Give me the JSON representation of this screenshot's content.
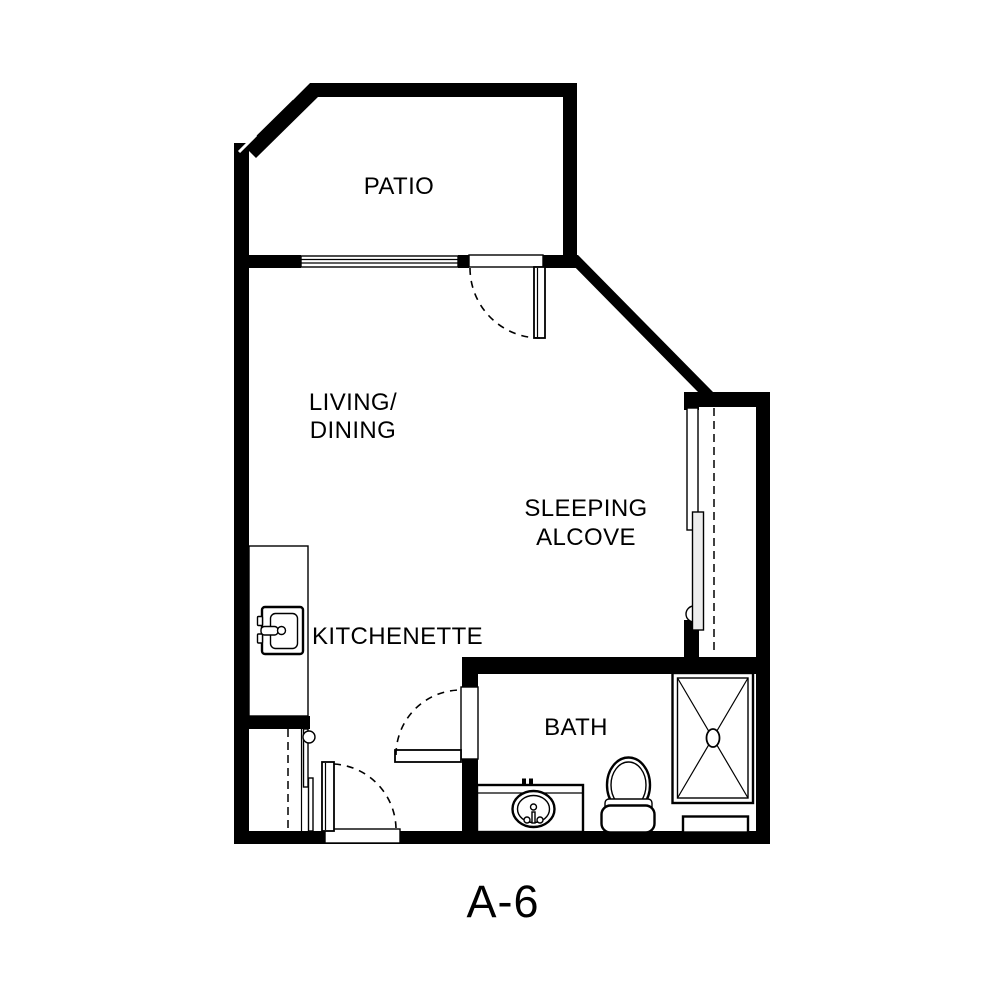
{
  "plan": {
    "title": "A-6",
    "type": "apartment-floor-plan",
    "colors": {
      "background": "#ffffff",
      "wall": "#000000",
      "line": "#000000"
    }
  },
  "rooms": {
    "patio": {
      "label": "PATIO"
    },
    "living_dining": {
      "line1": "LIVING/",
      "line2": "DINING"
    },
    "sleeping_alcove": {
      "line1": "SLEEPING",
      "line2": "ALCOVE"
    },
    "kitchenette": {
      "label": "KITCHENETTE"
    },
    "bath": {
      "label": "BATH"
    }
  },
  "fixtures": [
    {
      "name": "kitchen-sink"
    },
    {
      "name": "kitchen-counter"
    },
    {
      "name": "bath-vanity-sink"
    },
    {
      "name": "toilet"
    },
    {
      "name": "shower"
    },
    {
      "name": "patio-window"
    },
    {
      "name": "patio-swing-door"
    },
    {
      "name": "entry-swing-door"
    },
    {
      "name": "bath-swing-door"
    },
    {
      "name": "sleeping-alcove-sliding-closet"
    },
    {
      "name": "entry-sliding-closet"
    }
  ]
}
